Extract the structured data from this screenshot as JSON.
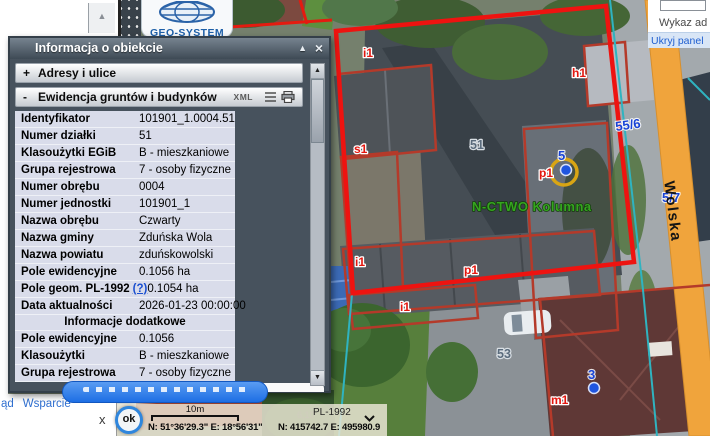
{
  "window": {
    "title": "Informacja o obiekcie",
    "collapse": "▲",
    "close": "×"
  },
  "logo": {
    "brand": "GEO-SYSTEM"
  },
  "top_right": {
    "list_label": "Wykaz ad",
    "hide_panel": "Ukryj panel"
  },
  "sections": {
    "addresses": {
      "prefix": "+",
      "label": "Adresy i ulice"
    },
    "egib": {
      "prefix": "-",
      "label": "Ewidencja gruntów i budynków",
      "xml_label": "XML"
    }
  },
  "table": {
    "rows": [
      {
        "label": "Identyfikator",
        "value": "101901_1.0004.51"
      },
      {
        "label": "Numer działki",
        "value": "51"
      },
      {
        "label": "Klasoużytki EGiB",
        "value": "B - mieszkaniowe"
      },
      {
        "label": "Grupa rejestrowa",
        "value": "7 - osoby fizyczne"
      },
      {
        "label": "Numer obrębu",
        "value": "0004"
      },
      {
        "label": "Numer jednostki",
        "value": "101901_1"
      },
      {
        "label": "Nazwa obrębu",
        "value": "Czwarty"
      },
      {
        "label": "Nazwa gminy",
        "value": "Zduńska Wola"
      },
      {
        "label": "Nazwa powiatu",
        "value": "zduńskowolski"
      },
      {
        "label": "Pole ewidencyjne",
        "value": "0.1056 ha"
      },
      {
        "label": "Pole geom. PL-1992",
        "link": "(?)",
        "value": "0.1054 ha"
      },
      {
        "label": "Data aktualności",
        "value": "2026-01-23 00:00:00"
      }
    ]
  },
  "extra": {
    "header": "Informacje dodatkowe",
    "rows": [
      {
        "label": "Pole ewidencyjne",
        "value": "0.1056"
      },
      {
        "label": "Klasoużytki",
        "value": "B - mieszkaniowe"
      },
      {
        "label": "Grupa rejestrowa",
        "value": "7 - osoby fizyczne"
      }
    ]
  },
  "bottom_left": {
    "link1": "ąd",
    "link2": "Wsparcie",
    "close": "x"
  },
  "status_bar": {
    "ok": "ok",
    "scale": "10m",
    "crs": "PL-1992",
    "geo": "N: 51°36'29.3\"  E: 18°56'31\"",
    "plane": "N: 415742.7   E: 495980.9"
  },
  "map": {
    "labels": [
      {
        "t": "i1",
        "x": 363,
        "y": 57,
        "k": "red"
      },
      {
        "t": "s1",
        "x": 354,
        "y": 153,
        "k": "red"
      },
      {
        "t": "h1",
        "x": 572,
        "y": 77,
        "k": "red"
      },
      {
        "t": "p1",
        "x": 539,
        "y": 177,
        "k": "red"
      },
      {
        "t": "i1",
        "x": 355,
        "y": 266,
        "k": "red"
      },
      {
        "t": "p1",
        "x": 464,
        "y": 274,
        "k": "red"
      },
      {
        "t": "i1",
        "x": 400,
        "y": 311,
        "k": "red"
      },
      {
        "t": "m1",
        "x": 551,
        "y": 404,
        "k": "red"
      },
      {
        "t": "51",
        "x": 470,
        "y": 149,
        "k": "gray"
      },
      {
        "t": "53",
        "x": 497,
        "y": 358,
        "k": "gray"
      },
      {
        "t": "5",
        "x": 558,
        "y": 160,
        "k": "blue"
      },
      {
        "t": "3",
        "x": 588,
        "y": 379,
        "k": "blue"
      },
      {
        "t": "55/6",
        "x": 616,
        "y": 131,
        "k": "blue",
        "r": -8
      },
      {
        "t": "5/7",
        "x": 662,
        "y": 202,
        "k": "blue"
      },
      {
        "t": "N-CTWO Kolumna",
        "x": 472,
        "y": 211,
        "k": "green"
      },
      {
        "t": "6,10",
        "x": 297,
        "y": 418,
        "k": "dim"
      },
      {
        "t": "Wolska",
        "x": 668,
        "y": 212,
        "k": "street",
        "r": 83,
        "anchor": "middle"
      }
    ],
    "markers": [
      {
        "type": "ring",
        "cx": 564,
        "cy": 172,
        "r": 13
      },
      {
        "type": "dot",
        "cx": 566,
        "cy": 170,
        "r": 5.5
      },
      {
        "type": "dot",
        "cx": 594,
        "cy": 388,
        "r": 5.5
      }
    ],
    "colors": {
      "parcel": "#ee1310",
      "building_outline": "#b43a2a",
      "cadastre_line": "#2fb3c0",
      "street_band": "#f0a43c",
      "marker_ring": "#d9a514",
      "marker_dot": "#1f55e0"
    }
  }
}
